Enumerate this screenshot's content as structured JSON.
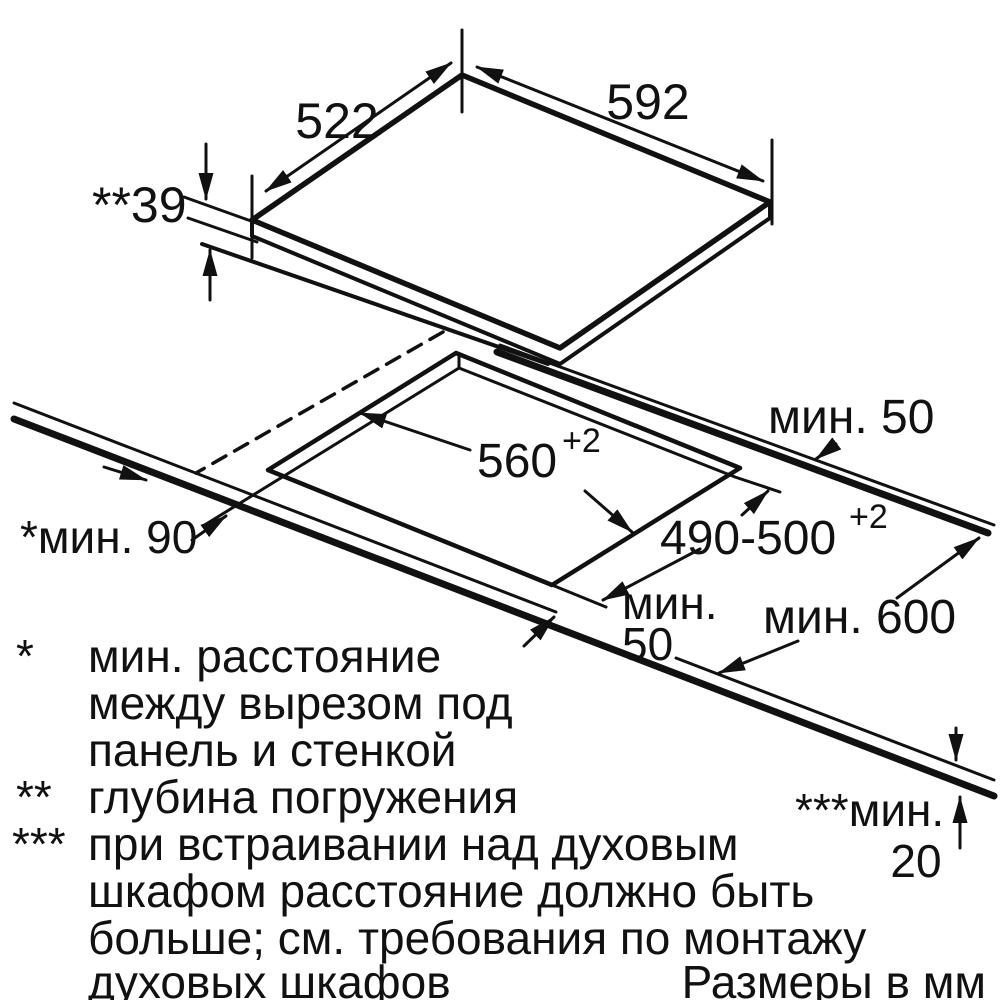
{
  "figure": {
    "panel": {
      "width": "592",
      "depth": "522",
      "immersion": "**39"
    },
    "cutout": {
      "width": "560",
      "width_sup": "+2",
      "depth": "490-500",
      "depth_sup": "+2"
    },
    "clearances": {
      "rear": "мин. 50",
      "front_line1": "мин.",
      "front_line2": "50",
      "worktop_depth": "мин. 600",
      "side": "*мин. 90",
      "below_prefix": "***мин.",
      "below_value": "20"
    }
  },
  "footnotes": {
    "items": [
      {
        "marker": "*",
        "lines": [
          "мин. расстояние",
          "между вырезом под",
          "панель и стенкой"
        ]
      },
      {
        "marker": "**",
        "lines": [
          "глубина погружения"
        ]
      },
      {
        "marker": "***",
        "lines": [
          "при встраивании над духовым",
          "шкафом расстояние должно быть",
          "больше; см. требования по монтажу",
          "духовых шкафов"
        ]
      }
    ]
  },
  "caption": "Размеры в мм",
  "colors": {
    "ink": "#111111",
    "background": "#ffffff"
  }
}
